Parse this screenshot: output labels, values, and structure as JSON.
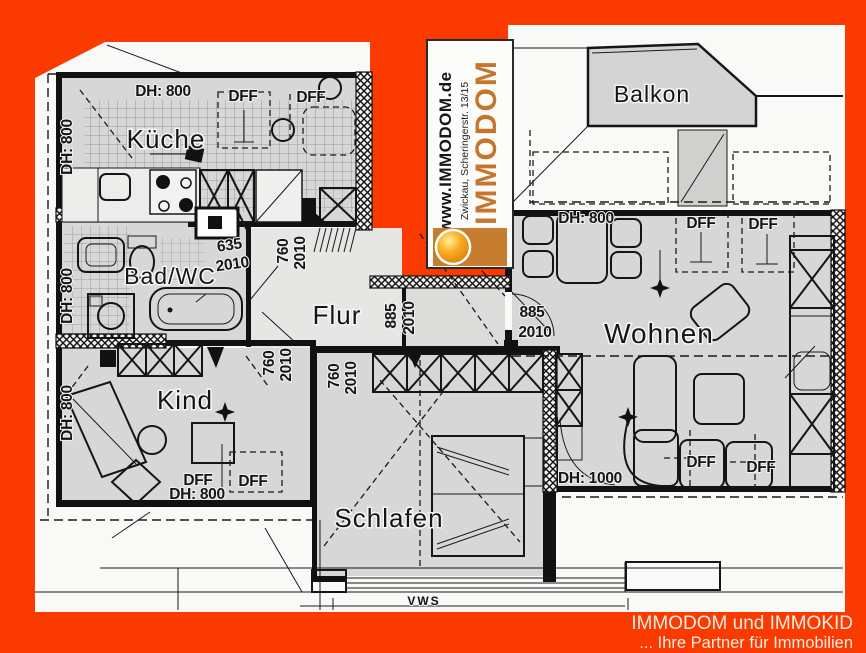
{
  "colors": {
    "frame_orange": "#fb3a00",
    "paper": "#f9f9f7",
    "room_gray": "#d7d7d7",
    "wall_black": "#111111",
    "brand_orange": "#c5762c",
    "footer_text": "#f8ece3"
  },
  "logo": {
    "site": "www.IMMODOM.de",
    "address": "Zwickau, Scheringerstr. 13/15",
    "brand": "IMMODOM",
    "ball_icon": "orange-sphere"
  },
  "footer": {
    "line1": "IMMODOM und IMMOKID",
    "line2": "... Ihre Partner für Immobilien"
  },
  "rooms": [
    {
      "id": "kueche",
      "label": "Küche"
    },
    {
      "id": "bad-wc",
      "label": "Bad/WC"
    },
    {
      "id": "flur",
      "label": "Flur"
    },
    {
      "id": "kind",
      "label": "Kind"
    },
    {
      "id": "schlafen",
      "label": "Schlafen"
    },
    {
      "id": "wohnen",
      "label": "Wohnen"
    },
    {
      "id": "balkon",
      "label": "Balkon"
    }
  ],
  "measurements": [
    {
      "text": "DH: 800"
    },
    {
      "text": "DFF"
    },
    {
      "text": "DFF"
    },
    {
      "text": "DH: 800"
    },
    {
      "text": "DH: 800"
    },
    {
      "text": "DH: 800"
    },
    {
      "text": "635"
    },
    {
      "text": "2010"
    },
    {
      "text": "760"
    },
    {
      "text": "2010"
    },
    {
      "text": "885"
    },
    {
      "text": "2010"
    },
    {
      "text": "885"
    },
    {
      "text": "2010"
    },
    {
      "text": "DH: 800"
    },
    {
      "text": "DFF"
    },
    {
      "text": "DFF"
    },
    {
      "text": "760"
    },
    {
      "text": "2010"
    },
    {
      "text": "760"
    },
    {
      "text": "2010"
    },
    {
      "text": "DH: 1000"
    },
    {
      "text": "DFF"
    },
    {
      "text": "DFF"
    },
    {
      "text": "DFF"
    },
    {
      "text": "DH: 800"
    },
    {
      "text": "DFF"
    },
    {
      "text": "VWS"
    }
  ]
}
